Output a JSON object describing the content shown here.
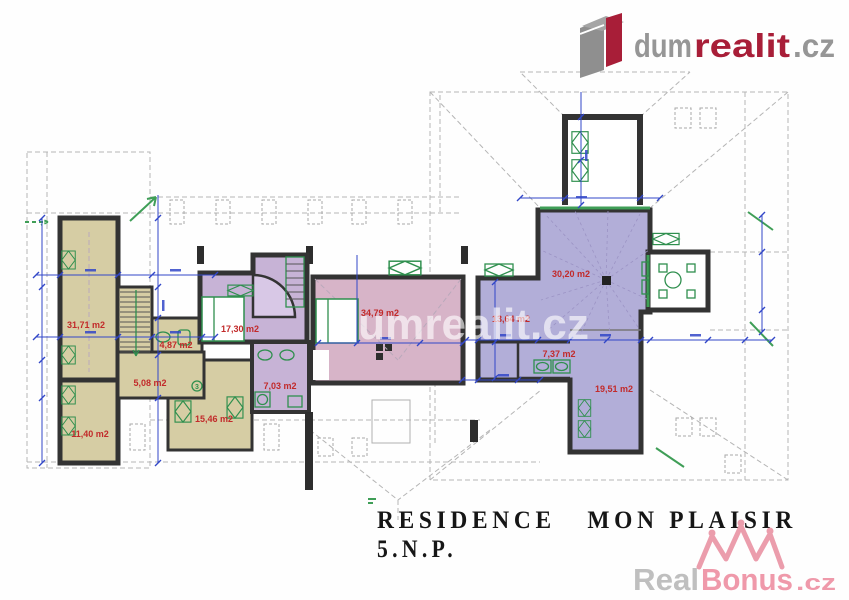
{
  "brand_header": {
    "prefix": "dum",
    "accent": "realit",
    "suffix": ".cz"
  },
  "watermarks": {
    "center": "dumrealit.cz",
    "bottom": {
      "prefix": "Real",
      "accent": "Bonus",
      "suffix": ".cz"
    }
  },
  "plan": {
    "floor_title": "RESIDENCE   MON PLAISIR",
    "floor_level": "5.N.P.",
    "rooms": [
      {
        "name": "room-top-left",
        "area": "31,71 m2"
      },
      {
        "name": "room-bottom-left",
        "area": "11,40 m2"
      },
      {
        "name": "bath-left",
        "area": "4,87 m2"
      },
      {
        "name": "hall-left",
        "area": "5,08 m2"
      },
      {
        "name": "room-center-left",
        "area": "15,46 m2"
      },
      {
        "name": "bedroom-left",
        "area": "17,30 m2"
      },
      {
        "name": "bedroom-large",
        "area": "34,79 m2"
      },
      {
        "name": "bath-center",
        "area": "7,03 m2"
      },
      {
        "name": "room-right-a",
        "area": "13,64 m2"
      },
      {
        "name": "living-tower",
        "area": "30,20 m2"
      },
      {
        "name": "bath-right",
        "area": "7,37 m2"
      },
      {
        "name": "room-right-b",
        "area": "19,51 m2"
      }
    ],
    "fixture_note": "3"
  },
  "colors": {
    "khaki": "#d6cda4",
    "lavender": "#c7b3d6",
    "pink": "#d7b4c8",
    "violet": "#b2aed8",
    "wall": "#333333",
    "fixture_green": "#2f8f4e",
    "dimension_blue": "#3247c8",
    "label_red": "#c22a2a",
    "roof_gray": "#b5b5b5",
    "logo_gray": "#969696",
    "logo_red": "#a81e38",
    "bonus_pink": "#ee8fa2",
    "real_gray": "#b9b9b9"
  }
}
